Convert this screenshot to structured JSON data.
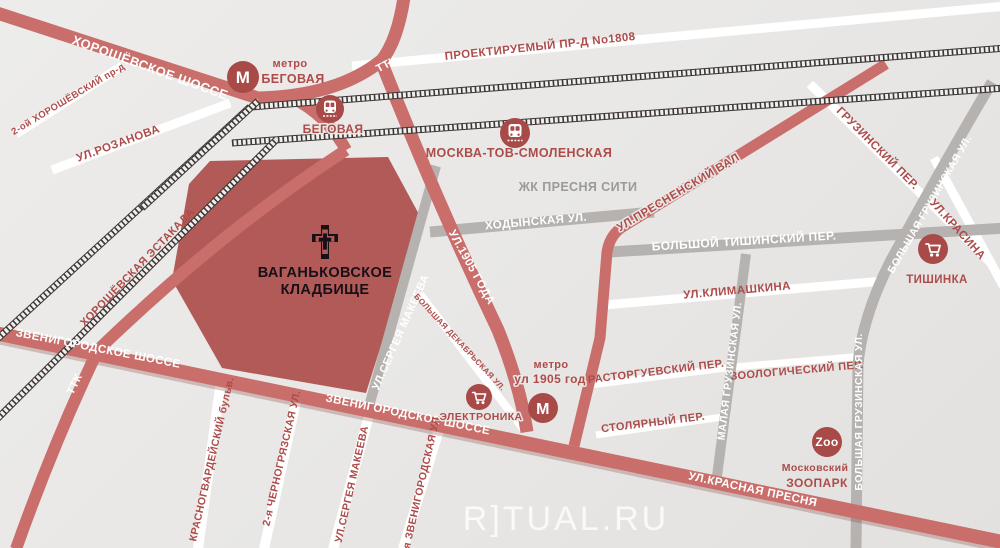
{
  "map": {
    "watermark": "R]TUAL.RU",
    "cemetery": {
      "line1": "ВАГАНЬКОВСКОЕ",
      "line2": "КЛАДБИЩЕ"
    },
    "roads": {
      "khoroshevskoe": "ХОРОШЁВСКОЕ ШОССЕ",
      "khoroshevsky_proezd": "2-ой ХОРОШЁВСКИЙ пр-д",
      "rozanova": "УЛ.РОЗАНОВА",
      "ttk_top": "ТТК",
      "ttk_bottom": "ТТК",
      "proektiruemy": "ПРОЕКТИРУЕМЫЙ ПР-Д No1808",
      "khoroshevskaya_estakada": "ХОРОШЁВСКАЯ ЭСТАКАДА",
      "zvenigorodskoe_1": "ЗВЕНИГОРОДСКОЕ ШОССЕ",
      "zvenigorodskoe_2": "ЗВЕНИГОРОДСКОЕ ШОССЕ",
      "ul_1905": "УЛ.1905 ГОДА",
      "khodynskaya": "ХОДЫНСКАЯ УЛ.",
      "presnensky_val": "УЛ.ПРЕСНЕНСКИЙ ВАЛ",
      "bolshoy_tishinsky": "БОЛЬШОЙ ТИШИНСКИЙ ПЕР.",
      "gruzinsky_per": "ГРУЗИНСКИЙ ПЕР.",
      "bolshaya_gruzinskaya_1": "БОЛЬШАЯ ГРУЗИНСКАЯ УЛ.",
      "bolshaya_gruzinskaya_2": "БОЛЬШАЯ ГРУЗИНСКАЯ УЛ.",
      "malaya_gruzinskaya": "МАЛАЯ ГРУЗИНСКАЯ УЛ.",
      "krasina": "УЛ.КРАСИНА",
      "klimashkina": "УЛ.КЛИМАШКИНА",
      "rastorguevsky": "РАСТОРГУЕВСКИЙ ПЕР.",
      "zoologichesky": "ЗООЛОГИЧЕСКИЙ ПЕР.",
      "stolyarny": "СТОЛЯРНЫЙ ПЕР.",
      "sergeya_makeeva_1": "УЛ.СЕРГЕЯ МАКЕЕВА",
      "sergeya_makeeva_2": "УЛ.СЕРГЕЯ МАКЕЕВА",
      "bolshaya_dekabrskaya": "БОЛЬШАЯ ДЕКАБРЬСКАЯ УЛ.",
      "krasnogvardeisky": "КРАСНОГВАРДЕЙСКИЙ бульв.",
      "chernogryazskaya": "2-я ЧЕРНОГРЯЗСКАЯ УЛ.",
      "zvenigorodskaya_2ya": "2-я ЗВЕНИГОРОДСКАЯ УЛ.",
      "krasnaya_presnya": "УЛ.КРАСНАЯ ПРЕСНЯ"
    },
    "stations": {
      "metro_begovaya": {
        "kind": "метро",
        "name": "БЕГОВАЯ",
        "icon_letter": "М"
      },
      "rail_begovaya": {
        "name": "БЕГОВАЯ"
      },
      "rail_smolenskaya": {
        "name": "МОСКВА-ТОВ-СМОЛЕНСКАЯ"
      },
      "metro_1905": {
        "kind": "метро",
        "name": "ул 1905 год",
        "icon_letter": "М"
      }
    },
    "places": {
      "presnya_city": "ЖК ПРЕСНЯ СИТИ",
      "elektronika": "ЭЛЕКТРОНИКА",
      "tishinka": "ТИШИНКА",
      "zoo": {
        "badge": "Zoo",
        "line1": "Московский",
        "line2": "ЗООПАРК"
      }
    },
    "colors": {
      "road_red": "#c96e6b",
      "road_gray": "#b6b2b0",
      "road_white": "#ffffff",
      "cemetery_fill": "#b25a58",
      "text_red": "#ad4c4a",
      "text_gray": "#9c9a99",
      "icon_red": "#a84a48",
      "background": "#e9e8e6"
    }
  }
}
